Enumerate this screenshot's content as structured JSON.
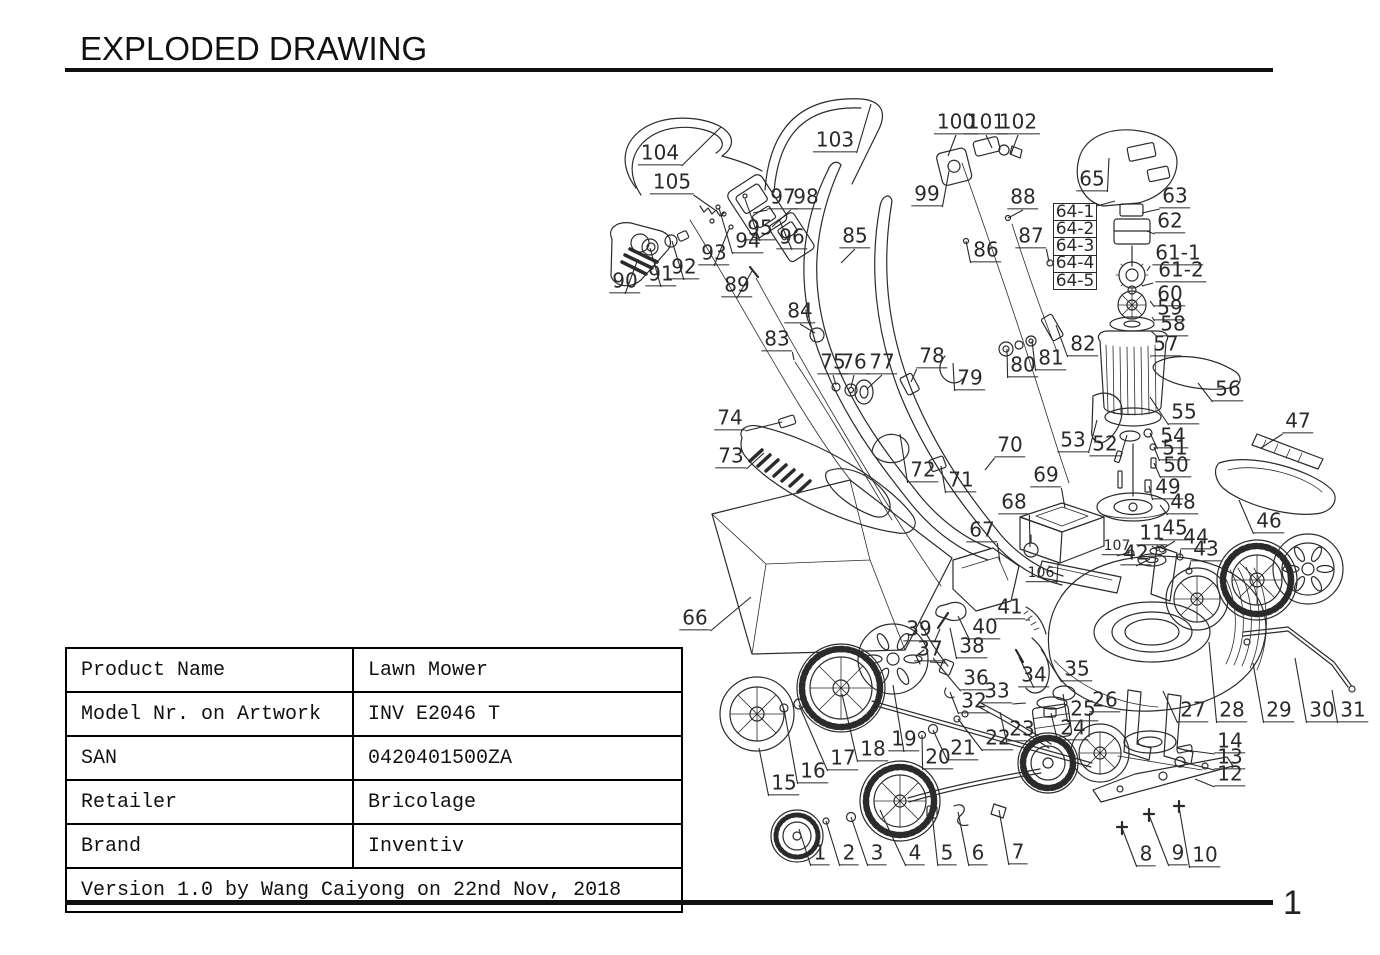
{
  "page": {
    "title": "EXPLODED DRAWING",
    "page_number": "1"
  },
  "info_table": {
    "rows": [
      {
        "label": "Product Name",
        "value": "Lawn Mower"
      },
      {
        "label": "Model Nr. on Artwork",
        "value": "INV E2046 T"
      },
      {
        "label": "SAN",
        "value": "0420401500ZA"
      },
      {
        "label": "Retailer",
        "value": "Bricolage"
      },
      {
        "label": "Brand",
        "value": "Inventiv"
      }
    ],
    "footer": "Version 1.0 by Wang Caiyong on 22nd Nov, 2018"
  },
  "diagram": {
    "ink_color": "#2a2a2a",
    "stack_labels": {
      "items": [
        "64-1",
        "64-2",
        "64-3",
        "64-4",
        "64-5"
      ],
      "x": 1053,
      "y": 203,
      "cell_w": 44,
      "cell_h": 17.2,
      "leader": [
        1097,
        206,
        1115,
        201
      ]
    },
    "labels": [
      {
        "t": "1",
        "x": 820,
        "y": 855,
        "tx": 799,
        "ty": 829
      },
      {
        "t": "2",
        "x": 849,
        "y": 855,
        "tx": 826,
        "ty": 821
      },
      {
        "t": "3",
        "x": 877,
        "y": 855,
        "tx": 851,
        "ty": 817
      },
      {
        "t": "4",
        "x": 915,
        "y": 855,
        "tx": 880,
        "ty": 810
      },
      {
        "t": "5",
        "x": 947,
        "y": 855,
        "tx": 932,
        "ty": 813
      },
      {
        "t": "6",
        "x": 978,
        "y": 855,
        "tx": 958,
        "ty": 812
      },
      {
        "t": "7",
        "x": 1018,
        "y": 854,
        "tx": 999,
        "ty": 810
      },
      {
        "t": "8",
        "x": 1146,
        "y": 856,
        "tx": 1122,
        "ty": 828
      },
      {
        "t": "9",
        "x": 1178,
        "y": 855,
        "tx": 1149,
        "ty": 815
      },
      {
        "t": "10",
        "x": 1205,
        "y": 857,
        "tx": 1179,
        "ty": 807
      },
      {
        "t": "11",
        "x": 1152,
        "y": 535,
        "tx": 1158,
        "ty": 551
      },
      {
        "t": "12",
        "x": 1230,
        "y": 776,
        "tx": 1195,
        "ty": 779
      },
      {
        "t": "13",
        "x": 1230,
        "y": 759,
        "tx": 1182,
        "ty": 762
      },
      {
        "t": "14",
        "x": 1230,
        "y": 743,
        "tx": 1185,
        "ty": 750
      },
      {
        "t": "15",
        "x": 784,
        "y": 785,
        "tx": 759,
        "ty": 748
      },
      {
        "t": "16",
        "x": 813,
        "y": 773,
        "tx": 784,
        "ty": 709
      },
      {
        "t": "17",
        "x": 843,
        "y": 760,
        "tx": 799,
        "ty": 705
      },
      {
        "t": "18",
        "x": 873,
        "y": 751,
        "tx": 842,
        "ty": 694
      },
      {
        "t": "19",
        "x": 904,
        "y": 741,
        "tx": 893,
        "ty": 685
      },
      {
        "t": "20",
        "x": 938,
        "y": 759,
        "tx": 922,
        "ty": 735
      },
      {
        "t": "21",
        "x": 963,
        "y": 750,
        "tx": 933,
        "ty": 730
      },
      {
        "t": "22",
        "x": 998,
        "y": 740,
        "tx": 958,
        "ty": 719
      },
      {
        "t": "23",
        "x": 1022,
        "y": 731,
        "tx": 1000,
        "ty": 712
      },
      {
        "t": "24",
        "x": 1073,
        "y": 730,
        "tx": 1051,
        "ty": 713
      },
      {
        "t": "25",
        "x": 1083,
        "y": 711,
        "tx": 1063,
        "ty": 694
      },
      {
        "t": "26",
        "x": 1105,
        "y": 702,
        "tx": 1089,
        "ty": 737
      },
      {
        "t": "27",
        "x": 1193,
        "y": 712,
        "tx": 1163,
        "ty": 691
      },
      {
        "t": "28",
        "x": 1232,
        "y": 712,
        "tx": 1209,
        "ty": 642
      },
      {
        "t": "29",
        "x": 1279,
        "y": 712,
        "tx": 1253,
        "ty": 663
      },
      {
        "t": "30",
        "x": 1322,
        "y": 712,
        "tx": 1295,
        "ty": 658
      },
      {
        "t": "31",
        "x": 1353,
        "y": 712,
        "tx": 1332,
        "ty": 690
      },
      {
        "t": "32",
        "x": 974,
        "y": 703,
        "tx": 950,
        "ty": 692
      },
      {
        "t": "33",
        "x": 997,
        "y": 693,
        "tx": 1026,
        "ty": 703
      },
      {
        "t": "34",
        "x": 1034,
        "y": 677,
        "tx": 1019,
        "ty": 657
      },
      {
        "t": "35",
        "x": 1077,
        "y": 671,
        "tx": 1041,
        "ty": 649
      },
      {
        "t": "36",
        "x": 976,
        "y": 680,
        "tx": 933,
        "ty": 658
      },
      {
        "t": "37",
        "x": 930,
        "y": 651,
        "tx": 945,
        "ty": 663
      },
      {
        "t": "38",
        "x": 972,
        "y": 648,
        "tx": 950,
        "ty": 628
      },
      {
        "t": "39",
        "x": 919,
        "y": 631,
        "tx": 940,
        "ty": 629
      },
      {
        "t": "40",
        "x": 985,
        "y": 629,
        "tx": 958,
        "ty": 616
      },
      {
        "t": "41",
        "x": 1010,
        "y": 609,
        "tx": 1030,
        "ty": 620
      },
      {
        "t": "42",
        "x": 1136,
        "y": 555,
        "tx": 1150,
        "ty": 559
      },
      {
        "t": "43",
        "x": 1206,
        "y": 551,
        "tx": 1189,
        "ty": 570
      },
      {
        "t": "44",
        "x": 1196,
        "y": 539,
        "tx": 1180,
        "ty": 557
      },
      {
        "t": "45",
        "x": 1175,
        "y": 530,
        "tx": 1162,
        "ty": 549
      },
      {
        "t": "46",
        "x": 1269,
        "y": 523,
        "tx": 1239,
        "ty": 500
      },
      {
        "t": "47",
        "x": 1298,
        "y": 423,
        "tx": 1261,
        "ty": 448
      },
      {
        "t": "48",
        "x": 1183,
        "y": 504,
        "tx": 1160,
        "ty": 505
      },
      {
        "t": "49",
        "x": 1168,
        "y": 489,
        "tx": 1149,
        "ty": 486
      },
      {
        "t": "50",
        "x": 1176,
        "y": 467,
        "tx": 1154,
        "ty": 463
      },
      {
        "t": "51",
        "x": 1175,
        "y": 450,
        "tx": 1154,
        "ty": 447
      },
      {
        "t": "52",
        "x": 1105,
        "y": 446,
        "tx": 1127,
        "ty": 435
      },
      {
        "t": "53",
        "x": 1073,
        "y": 442,
        "tx": 1097,
        "ty": 420
      },
      {
        "t": "54",
        "x": 1173,
        "y": 438,
        "tx": 1150,
        "ty": 433
      },
      {
        "t": "55",
        "x": 1184,
        "y": 414,
        "tx": 1150,
        "ty": 397
      },
      {
        "t": "56",
        "x": 1228,
        "y": 391,
        "tx": 1198,
        "ty": 383
      },
      {
        "t": "57",
        "x": 1166,
        "y": 346,
        "tx": 1150,
        "ty": 357
      },
      {
        "t": "58",
        "x": 1173,
        "y": 326,
        "tx": 1151,
        "ty": 331
      },
      {
        "t": "59",
        "x": 1170,
        "y": 310,
        "tx": 1152,
        "ty": 317
      },
      {
        "t": "60",
        "x": 1170,
        "y": 296,
        "tx": 1150,
        "ty": 301
      },
      {
        "t": "61-1",
        "x": 1178,
        "y": 255,
        "tx": 1147,
        "ty": 271
      },
      {
        "t": "61-2",
        "x": 1181,
        "y": 272,
        "tx": 1142,
        "ty": 286
      },
      {
        "t": "62",
        "x": 1170,
        "y": 223,
        "tx": 1147,
        "ty": 231
      },
      {
        "t": "63",
        "x": 1175,
        "y": 198,
        "tx": 1142,
        "ty": 213
      },
      {
        "t": "65",
        "x": 1092,
        "y": 181,
        "tx": 1109,
        "ty": 158
      },
      {
        "t": "66",
        "x": 695,
        "y": 620,
        "tx": 751,
        "ty": 597
      },
      {
        "t": "67",
        "x": 982,
        "y": 532,
        "tx": 1000,
        "ty": 562
      },
      {
        "t": "68",
        "x": 1014,
        "y": 504,
        "tx": 1030,
        "ty": 547
      },
      {
        "t": "69",
        "x": 1046,
        "y": 477,
        "tx": 1065,
        "ty": 508
      },
      {
        "t": "70",
        "x": 1010,
        "y": 447,
        "tx": 985,
        "ty": 470
      },
      {
        "t": "71",
        "x": 961,
        "y": 482,
        "tx": 941,
        "ty": 466
      },
      {
        "t": "72",
        "x": 923,
        "y": 472,
        "tx": 900,
        "ty": 434
      },
      {
        "t": "73",
        "x": 731,
        "y": 458,
        "tx": 764,
        "ty": 453
      },
      {
        "t": "74",
        "x": 730,
        "y": 420,
        "tx": 782,
        "ty": 422
      },
      {
        "t": "75",
        "x": 833,
        "y": 364,
        "tx": 836,
        "ty": 385
      },
      {
        "t": "76",
        "x": 854,
        "y": 364,
        "tx": 851,
        "ty": 387
      },
      {
        "t": "77",
        "x": 882,
        "y": 364,
        "tx": 867,
        "ty": 389
      },
      {
        "t": "78",
        "x": 932,
        "y": 358,
        "tx": 911,
        "ty": 382
      },
      {
        "t": "79",
        "x": 970,
        "y": 380,
        "tx": 953,
        "ty": 363
      },
      {
        "t": "80",
        "x": 1023,
        "y": 367,
        "tx": 1007,
        "ty": 349
      },
      {
        "t": "81",
        "x": 1051,
        "y": 360,
        "tx": 1032,
        "ty": 341
      },
      {
        "t": "82",
        "x": 1083,
        "y": 346,
        "tx": 1056,
        "ty": 325
      },
      {
        "t": "83",
        "x": 777,
        "y": 341,
        "tx": 794,
        "ty": 360
      },
      {
        "t": "84",
        "x": 800,
        "y": 313,
        "tx": 815,
        "ty": 333
      },
      {
        "t": "85",
        "x": 855,
        "y": 238,
        "tx": 841,
        "ty": 263
      },
      {
        "t": "86",
        "x": 986,
        "y": 252,
        "tx": 966,
        "ty": 241
      },
      {
        "t": "87",
        "x": 1031,
        "y": 238,
        "tx": 1049,
        "ty": 262
      },
      {
        "t": "88",
        "x": 1023,
        "y": 199,
        "tx": 1008,
        "ty": 218
      },
      {
        "t": "89",
        "x": 737,
        "y": 287,
        "tx": 752,
        "ty": 271
      },
      {
        "t": "90",
        "x": 625,
        "y": 283,
        "tx": 638,
        "ty": 259
      },
      {
        "t": "91",
        "x": 661,
        "y": 276,
        "tx": 650,
        "ty": 248
      },
      {
        "t": "92",
        "x": 684,
        "y": 269,
        "tx": 672,
        "ty": 241
      },
      {
        "t": "93",
        "x": 714,
        "y": 255,
        "tx": 729,
        "ty": 229
      },
      {
        "t": "94",
        "x": 748,
        "y": 243,
        "tx": 719,
        "ty": 208
      },
      {
        "t": "95",
        "x": 760,
        "y": 230,
        "tx": 745,
        "ty": 199
      },
      {
        "t": "96",
        "x": 792,
        "y": 239,
        "tx": 779,
        "ty": 219
      },
      {
        "t": "97",
        "x": 783,
        "y": 199,
        "tx": 753,
        "ty": 213
      },
      {
        "t": "98",
        "x": 806,
        "y": 199,
        "tx": 772,
        "ty": 227
      },
      {
        "t": "99",
        "x": 927,
        "y": 196,
        "tx": 949,
        "ty": 171
      },
      {
        "t": "100",
        "x": 956,
        "y": 124,
        "tx": 948,
        "ty": 156
      },
      {
        "t": "101",
        "x": 986,
        "y": 124,
        "tx": 992,
        "ty": 148
      },
      {
        "t": "102",
        "x": 1018,
        "y": 124,
        "tx": 1011,
        "ty": 154
      },
      {
        "t": "103",
        "x": 835,
        "y": 142,
        "tx": 871,
        "ty": 104
      },
      {
        "t": "104",
        "x": 660,
        "y": 155,
        "tx": 721,
        "ty": 127
      },
      {
        "t": "105",
        "x": 672,
        "y": 184,
        "tx": 715,
        "ty": 210
      },
      {
        "t": "106",
        "x": 1041,
        "y": 575,
        "tx": 1058,
        "ty": 562,
        "s": 1
      },
      {
        "t": "107",
        "x": 1117,
        "y": 548,
        "tx": 1130,
        "ty": 552,
        "s": 1
      }
    ]
  }
}
